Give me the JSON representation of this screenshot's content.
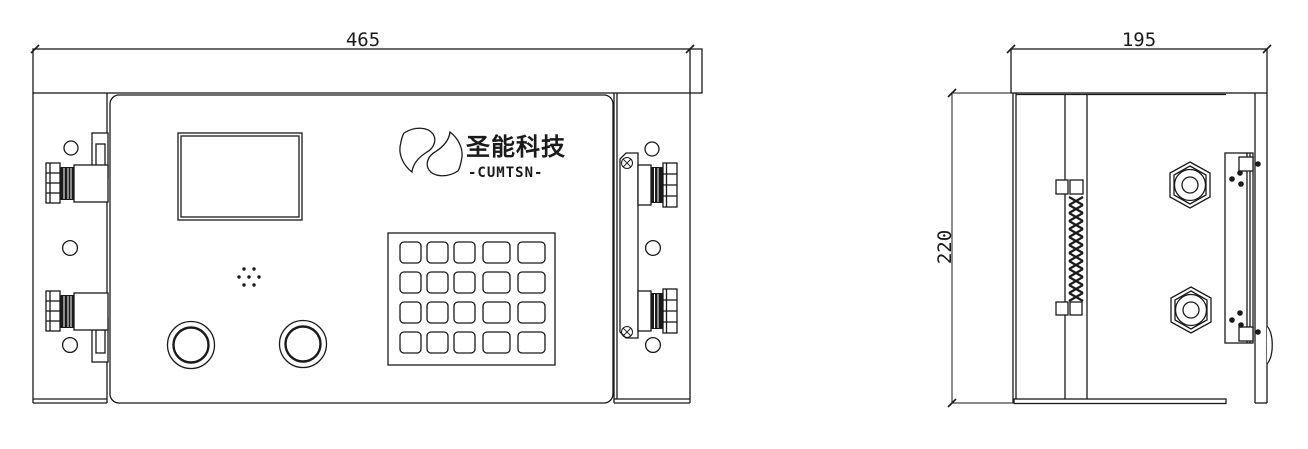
{
  "front_view": {
    "width_label": "465",
    "logo": {
      "brand_cn": "圣能科技",
      "brand_en": "-CUMTSN-"
    }
  },
  "side_view": {
    "width_label": "195",
    "height_label": "220"
  },
  "keypad": {
    "rows": 4,
    "cols": 5
  },
  "colors": {
    "line": "#1a1a1a",
    "background": "#ffffff"
  }
}
